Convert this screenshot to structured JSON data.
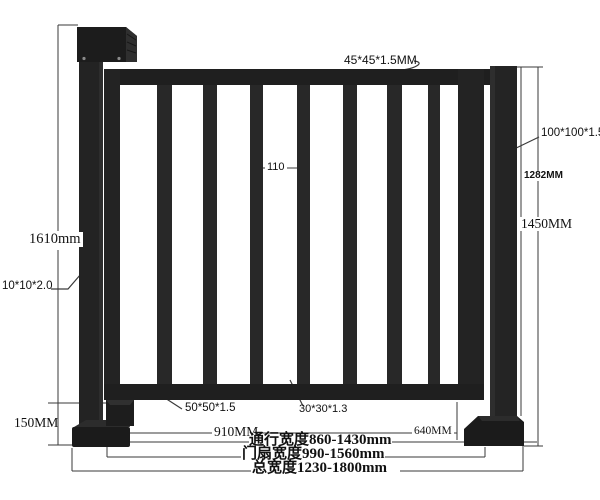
{
  "drawing": {
    "callouts": {
      "top_rail_tube": "45*45*1.5MM",
      "right_post_tube": "100*100*1.5",
      "left_post_tube": "10*10*2.0",
      "bottom_rail_tube": "50*50*1.5",
      "picket_tube": "30*30*1.3",
      "picket_spacing": "110"
    },
    "dimensions": {
      "overall_height": "1610mm",
      "base_height": "150MM",
      "post_height_inner": "1282MM",
      "post_height_outer": "1450MM",
      "leaf_bottom_span": "910MM",
      "right_span": "640MM",
      "passage_width": "通行宽度860-1430mm",
      "leaf_width": "门扇宽度990-1560mm",
      "total_width": "总宽度1230-1800mm"
    },
    "colors": {
      "structure": "#202020",
      "structure_light": "#2e2e2e",
      "dimension_line": "#3a3a3a",
      "background": "#ffffff"
    }
  }
}
